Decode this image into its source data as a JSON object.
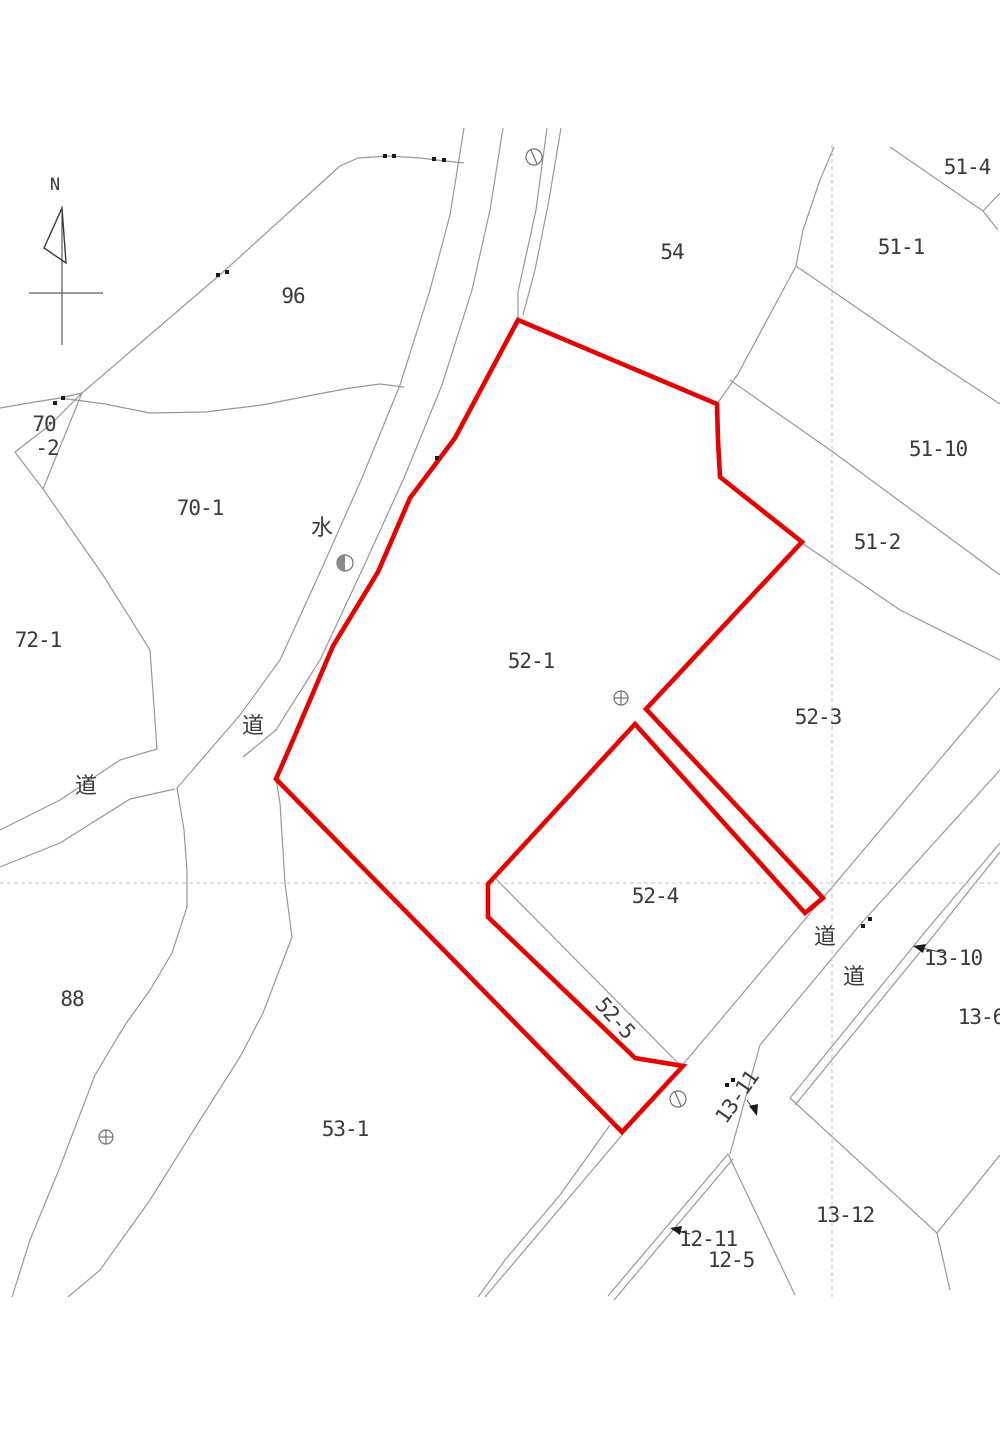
{
  "document": {
    "type": "japanese-cadastral-map",
    "background": "#ffffff"
  },
  "colors": {
    "highlight_red": "#e60000",
    "boundary_gray": "#98989c",
    "grid_dash_gray": "#c3c3c7",
    "label_text": "#3a3a3a"
  },
  "compass": {
    "label": "N"
  },
  "highlight": {
    "color": "#e60000",
    "outlined_parcels": [
      "52-1",
      "52-4",
      "52-5"
    ]
  },
  "labels": [
    {
      "id": "96",
      "text": "96"
    },
    {
      "id": "70-2a",
      "text": "70"
    },
    {
      "id": "70-2b",
      "text": "-2"
    },
    {
      "id": "70-1",
      "text": "70-1"
    },
    {
      "id": "water",
      "text": "水"
    },
    {
      "id": "72-1",
      "text": "72-1"
    },
    {
      "id": "54",
      "text": "54"
    },
    {
      "id": "51-4",
      "text": "51-4"
    },
    {
      "id": "51-1",
      "text": "51-1"
    },
    {
      "id": "51-10",
      "text": "51-10"
    },
    {
      "id": "51-2",
      "text": "51-2"
    },
    {
      "id": "52-1",
      "text": "52-1"
    },
    {
      "id": "52-3",
      "text": "52-3"
    },
    {
      "id": "road-center",
      "text": "道"
    },
    {
      "id": "road-left-branch",
      "text": "道"
    },
    {
      "id": "52-4",
      "text": "52-4"
    },
    {
      "id": "road-se-1",
      "text": "道"
    },
    {
      "id": "road-se-2",
      "text": "道"
    },
    {
      "id": "13-10",
      "text": "13-10"
    },
    {
      "id": "13-6",
      "text": "13-6"
    },
    {
      "id": "88",
      "text": "88"
    },
    {
      "id": "53-1",
      "text": "53-1"
    },
    {
      "id": "52-5",
      "text": "52-5"
    },
    {
      "id": "13-11",
      "text": "13-11"
    },
    {
      "id": "13-12",
      "text": "13-12"
    },
    {
      "id": "12-11",
      "text": "12-11"
    },
    {
      "id": "12-5",
      "text": "12-5"
    }
  ],
  "map_symbols": [
    {
      "name": "circle-slash-marker",
      "x": 534,
      "y": 157
    },
    {
      "name": "circle-halffill-marker",
      "x": 345,
      "y": 563
    },
    {
      "name": "crosshair-circle-marker",
      "x": 621,
      "y": 698
    },
    {
      "name": "crosshair-circle-marker",
      "x": 106,
      "y": 1137
    },
    {
      "name": "circle-slash-marker",
      "x": 678,
      "y": 1099
    }
  ],
  "annotation_arrows": [
    "13-10",
    "13-11",
    "12-11"
  ]
}
